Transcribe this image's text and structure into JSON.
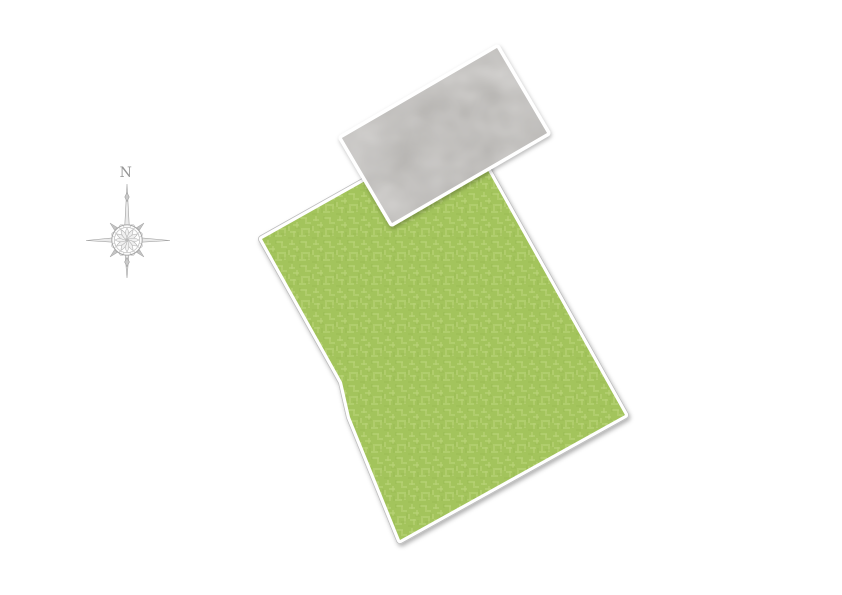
{
  "page": {
    "width_px": 842,
    "height_px": 595,
    "background": "#ffffff"
  },
  "compass": {
    "north_label": "N",
    "color": "#8d8d8d",
    "center_x": 127,
    "center_y": 240
  },
  "site_plan": {
    "parcel": {
      "kind": "lawn-parcel",
      "fill": "#a3c45c",
      "hatch_light": "#bdd67e",
      "hatch_dark": "#8fae47",
      "outline_white": "#ffffff",
      "outline_gray": "#bdbdbd",
      "points": "262,239 463,126 625,415 400,540 350,417 342,382"
    },
    "building": {
      "kind": "building-footprint",
      "fill": "#b4b2af",
      "outline_white": "#ffffff",
      "points": "342,138 497,48 547,133 392,223"
    }
  }
}
